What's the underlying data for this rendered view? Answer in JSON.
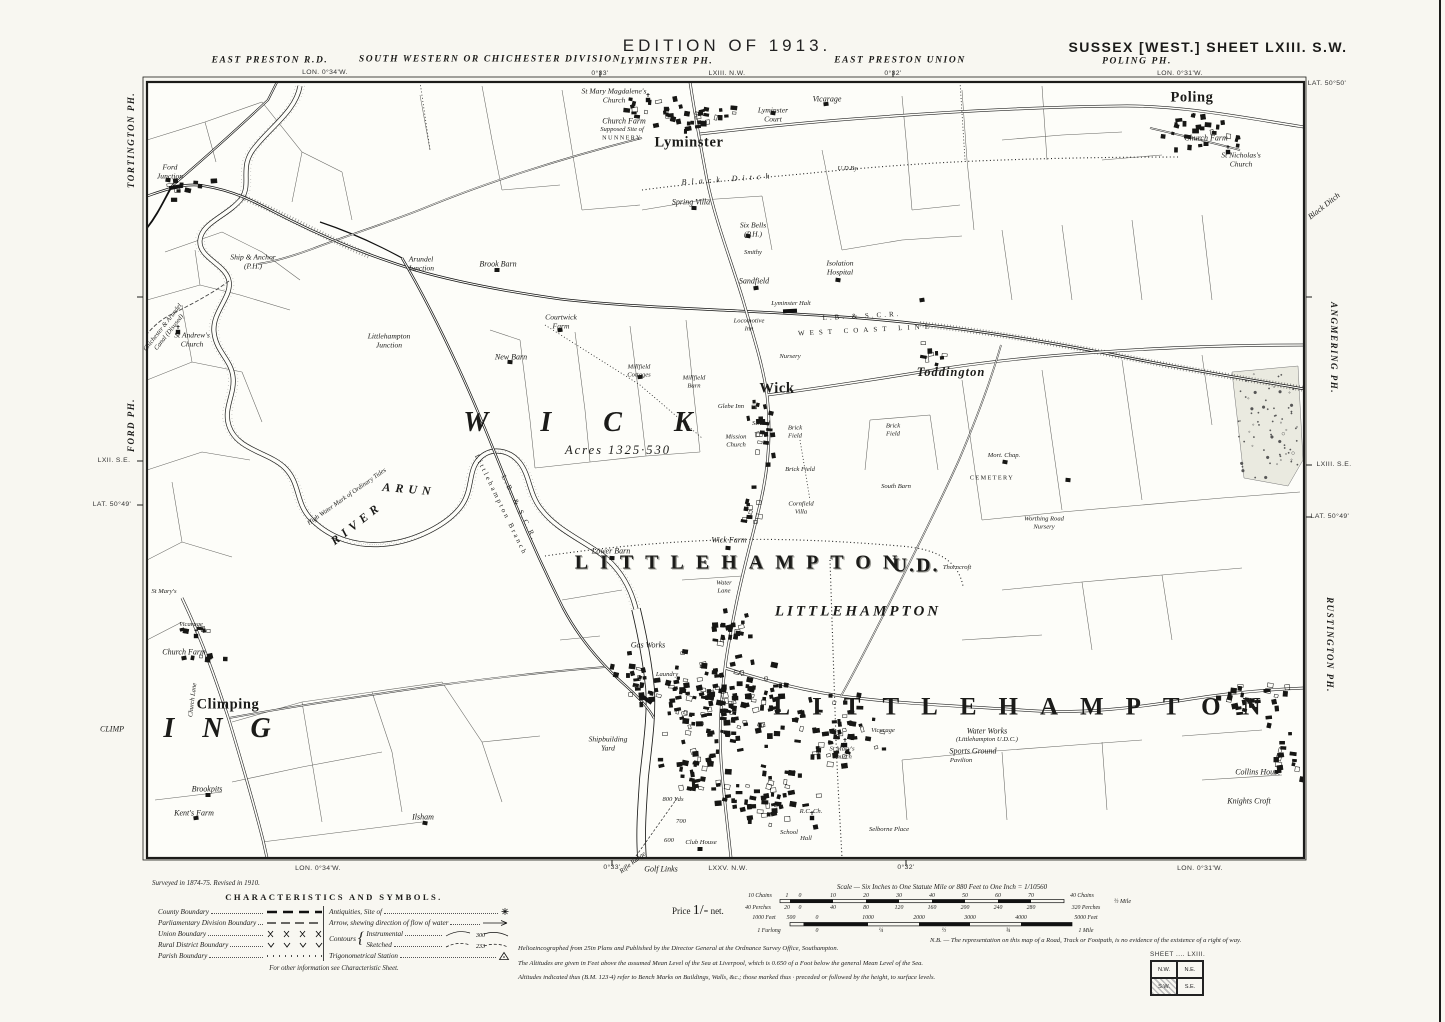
{
  "sheet_title": "SUSSEX [WEST.] SHEET LXIII. S.W.",
  "edition": "EDITION OF 1913.",
  "survey_note": "Surveyed in 1874-75.   Revised in 1910.",
  "price": {
    "prefix": "Price",
    "amount": "1/-",
    "suffix": "net."
  },
  "legend": {
    "title": "CHARACTERISTICS AND SYMBOLS.",
    "left": [
      {
        "label": "County Boundary",
        "sym": "county-dashes"
      },
      {
        "label": "Parliamentary Division Boundary",
        "sym": "thin-dashes"
      },
      {
        "label": "Union Boundary",
        "sym": "x-marks"
      },
      {
        "label": "Rural District Boundary",
        "sym": "v-marks"
      },
      {
        "label": "Parish Boundary",
        "sym": "dots"
      }
    ],
    "right": [
      {
        "label": "Antiquities, Site of",
        "sym": "antiquity-cross"
      },
      {
        "label": "Arrow, shewing direction of flow of water",
        "sym": "flow-arrow"
      }
    ],
    "contours": {
      "title": "Contours",
      "items": [
        {
          "label": "Instrumental",
          "value": "300"
        },
        {
          "label": "Sketched",
          "value": "233"
        }
      ]
    },
    "trig": {
      "label": "Trigonometrical Station",
      "sym": "trig-triangle"
    },
    "footnote": "For other information see Characteristic Sheet."
  },
  "scale": {
    "title": "Scale — Six Inches to One Statute Mile or 880 Feet to One Inch = 1/10560",
    "half_mile": "½ Mile",
    "tick_rows": [
      {
        "y": 893,
        "items": [
          {
            "t": "10 Chains",
            "x": 760
          },
          {
            "t": "1",
            "x": 787
          },
          {
            "t": "0",
            "x": 800
          },
          {
            "t": "10",
            "x": 833
          },
          {
            "t": "20",
            "x": 866
          },
          {
            "t": "30",
            "x": 899
          },
          {
            "t": "40",
            "x": 932
          },
          {
            "t": "50",
            "x": 965
          },
          {
            "t": "60",
            "x": 998
          },
          {
            "t": "70",
            "x": 1031
          },
          {
            "t": "40 Chains",
            "x": 1082
          }
        ]
      },
      {
        "y": 905,
        "items": [
          {
            "t": "40 Perches",
            "x": 758
          },
          {
            "t": "20",
            "x": 787
          },
          {
            "t": "0",
            "x": 800
          },
          {
            "t": "40",
            "x": 833
          },
          {
            "t": "80",
            "x": 866
          },
          {
            "t": "120",
            "x": 899
          },
          {
            "t": "160",
            "x": 932
          },
          {
            "t": "200",
            "x": 965
          },
          {
            "t": "240",
            "x": 998
          },
          {
            "t": "280",
            "x": 1031
          },
          {
            "t": "320 Perches",
            "x": 1086
          }
        ]
      },
      {
        "y": 915,
        "items": [
          {
            "t": "1000 Feet",
            "x": 764
          },
          {
            "t": "500",
            "x": 791
          },
          {
            "t": "0",
            "x": 817
          },
          {
            "t": "1000",
            "x": 868
          },
          {
            "t": "2000",
            "x": 919
          },
          {
            "t": "3000",
            "x": 970
          },
          {
            "t": "4000",
            "x": 1021
          },
          {
            "t": "5000 Feet",
            "x": 1086
          }
        ]
      },
      {
        "y": 928,
        "items": [
          {
            "t": "1 Furlong",
            "x": 769
          },
          {
            "t": "0",
            "x": 817
          },
          {
            "t": "¼",
            "x": 881
          },
          {
            "t": "½",
            "x": 944
          },
          {
            "t": "¾",
            "x": 1008
          },
          {
            "t": "1 Mile",
            "x": 1086
          }
        ]
      }
    ]
  },
  "notes": {
    "heliozincographed": "Heliozincographed from 25in Plans and Published by the Director General at the Ordnance Survey Office, Southampton.",
    "nb": "N.B. — The representation on this map of a Road, Track or Footpath, is no evidence of the existence of a right of way.",
    "altitudes1": "The Altitudes are given in Feet above the assumed Mean Level of the Sea at Liverpool, which is 0.650 of a Foot below the general Mean Level of the Sea.",
    "altitudes2": "Altitudes indicated thus (B.M. 123·4) refer to Bench Marks on Buildings, Walls, &c.; those marked thus · preceded or followed by the height, to surface levels."
  },
  "sheet_key": {
    "label": "SHEET .... LXIII.",
    "cells": [
      "N.W.",
      "N.E.",
      "S.W.",
      "S.E."
    ],
    "current": "S.W."
  },
  "map_labels": [
    {
      "t": "EDITION OF 1913.",
      "x": 727,
      "y": 46,
      "k": "hdr"
    },
    {
      "t": "SUSSEX [WEST.] SHEET LXIII. S.W.",
      "x": 1208,
      "y": 47,
      "k": "hdr2"
    },
    {
      "t": "EAST PRESTON R.D.",
      "x": 270,
      "y": 61,
      "k": "ph"
    },
    {
      "t": "LON. 0°34'W.",
      "x": 325,
      "y": 73,
      "k": "coord"
    },
    {
      "t": "SOUTH WESTERN OR CHICHESTER DIVISION",
      "x": 490,
      "y": 60,
      "k": "ph"
    },
    {
      "t": "LYMINSTER PH.",
      "x": 667,
      "y": 62,
      "k": "ph"
    },
    {
      "t": "LXIII. N.W.",
      "x": 727,
      "y": 74,
      "k": "coord"
    },
    {
      "t": "0°33'",
      "x": 600,
      "y": 74,
      "k": "coord"
    },
    {
      "t": "EAST PRESTON UNION",
      "x": 900,
      "y": 61,
      "k": "ph"
    },
    {
      "t": "0°32'",
      "x": 893,
      "y": 74,
      "k": "coord"
    },
    {
      "t": "POLING PH.",
      "x": 1137,
      "y": 62,
      "k": "ph"
    },
    {
      "t": "LON. 0°31'W.",
      "x": 1180,
      "y": 74,
      "k": "coord"
    },
    {
      "t": "LAT. 50°50'",
      "x": 1327,
      "y": 84,
      "k": "coord"
    },
    {
      "t": "TORTINGTON PH.",
      "x": 131,
      "y": 140,
      "k": "phv",
      "rot": -90
    },
    {
      "t": "FORD PH.",
      "x": 131,
      "y": 425,
      "k": "phv",
      "rot": -90
    },
    {
      "t": "LXII. S.E.",
      "x": 114,
      "y": 461,
      "k": "coord"
    },
    {
      "t": "LAT. 50°49'",
      "x": 112,
      "y": 505,
      "k": "coord"
    },
    {
      "t": "CLIMP",
      "x": 112,
      "y": 729,
      "k": "feat"
    },
    {
      "t": "Black Ditch",
      "x": 1324,
      "y": 206,
      "k": "feat",
      "rot": -38
    },
    {
      "t": "ANGMERING PH.",
      "x": 1334,
      "y": 348,
      "k": "phv",
      "rot": 90
    },
    {
      "t": "LXIII. S.E.",
      "x": 1334,
      "y": 465,
      "k": "coord"
    },
    {
      "t": "LAT. 50°49'",
      "x": 1330,
      "y": 517,
      "k": "coord"
    },
    {
      "t": "RUSTINGTON PH.",
      "x": 1330,
      "y": 645,
      "k": "phv",
      "rot": 90
    },
    {
      "t": "LON. 0°34'W.",
      "x": 318,
      "y": 869,
      "k": "coord"
    },
    {
      "t": "0°33'",
      "x": 612,
      "y": 868,
      "k": "coord"
    },
    {
      "t": "Rifle Range",
      "x": 633,
      "y": 863,
      "k": "tiny",
      "rot": -38
    },
    {
      "t": "Golf Links",
      "x": 661,
      "y": 869,
      "k": "feat"
    },
    {
      "t": "LXXV. N.W.",
      "x": 728,
      "y": 869,
      "k": "coord"
    },
    {
      "t": "0°32'",
      "x": 906,
      "y": 868,
      "k": "coord"
    },
    {
      "t": "LON. 0°31'W.",
      "x": 1200,
      "y": 869,
      "k": "coord"
    },
    {
      "t": "Ford\nJunction",
      "x": 170,
      "y": 172,
      "k": "feat2"
    },
    {
      "t": "Ship & Anchor\n(P.H.)",
      "x": 253,
      "y": 262,
      "k": "feat2"
    },
    {
      "t": "Arundel\nJunction",
      "x": 421,
      "y": 264,
      "k": "feat2"
    },
    {
      "t": "Brook Barn",
      "x": 498,
      "y": 264,
      "k": "feat"
    },
    {
      "t": "Littlehampton\nJunction",
      "x": 389,
      "y": 341,
      "k": "feat2"
    },
    {
      "t": "St Andrew's\nChurch",
      "x": 192,
      "y": 340,
      "k": "feat2"
    },
    {
      "t": "Chichester & Arundel\nCanal (Disused)",
      "x": 166,
      "y": 330,
      "k": "tiny",
      "rot": -52
    },
    {
      "t": "St Mary Magdalene's\nChurch",
      "x": 614,
      "y": 96,
      "k": "feat2"
    },
    {
      "t": "Church Farm",
      "x": 624,
      "y": 121,
      "k": "feat"
    },
    {
      "t": "Supposed Site of",
      "x": 622,
      "y": 130,
      "k": "tiny"
    },
    {
      "t": "NUNNERY",
      "x": 622,
      "y": 138,
      "k": "caps"
    },
    {
      "t": "Lyminster",
      "x": 689,
      "y": 143,
      "k": "town"
    },
    {
      "t": "Lyminster\nCourt",
      "x": 773,
      "y": 115,
      "k": "feat2"
    },
    {
      "t": "Vicarage",
      "x": 827,
      "y": 99,
      "k": "feat"
    },
    {
      "t": "Black Ditch",
      "x": 728,
      "y": 179,
      "k": "feat",
      "ls": 5,
      "rot": -4
    },
    {
      "t": "Spring Villa",
      "x": 691,
      "y": 202,
      "k": "feat"
    },
    {
      "t": "Six Bells\n(P.H.)",
      "x": 753,
      "y": 230,
      "k": "feat2"
    },
    {
      "t": "Smithy",
      "x": 753,
      "y": 253,
      "k": "tiny"
    },
    {
      "t": "Sandfield",
      "x": 754,
      "y": 281,
      "k": "feat"
    },
    {
      "t": "Isolation\nHospital",
      "x": 840,
      "y": 268,
      "k": "feat2"
    },
    {
      "t": "U.D.By.",
      "x": 848,
      "y": 169,
      "k": "tiny"
    },
    {
      "t": "Poling",
      "x": 1192,
      "y": 98,
      "k": "town"
    },
    {
      "t": "Church Farm",
      "x": 1206,
      "y": 138,
      "k": "feat"
    },
    {
      "t": "St Nicholas's\nChurch",
      "x": 1241,
      "y": 160,
      "k": "feat2"
    },
    {
      "t": "L.B. & S.C.R.",
      "x": 862,
      "y": 316,
      "k": "rail",
      "rot": -3,
      "ls": 3
    },
    {
      "t": "WEST COAST LINE",
      "x": 866,
      "y": 330,
      "k": "rail",
      "rot": -3,
      "ls": 5
    },
    {
      "t": "Lyminster Halt",
      "x": 791,
      "y": 304,
      "k": "tiny"
    },
    {
      "t": "Locomotive\nInn",
      "x": 749,
      "y": 325,
      "k": "tiny"
    },
    {
      "t": "L.B. & S.C.R.",
      "x": 519,
      "y": 508,
      "k": "rail",
      "rot": 64
    },
    {
      "t": "Littlehampton Branch",
      "x": 501,
      "y": 505,
      "k": "rail",
      "rot": 64
    },
    {
      "t": "Toddington",
      "x": 951,
      "y": 372,
      "k": "towni"
    },
    {
      "t": "Wick",
      "x": 777,
      "y": 389,
      "k": "town"
    },
    {
      "t": "Nursery",
      "x": 790,
      "y": 357,
      "k": "tiny"
    },
    {
      "t": "WICK",
      "x": 604,
      "y": 423,
      "k": "giant",
      "ls": 52
    },
    {
      "t": "Acres 1325·530",
      "x": 618,
      "y": 450,
      "k": "acres"
    },
    {
      "t": "Glebe Inn",
      "x": 731,
      "y": 407,
      "k": "tiny"
    },
    {
      "t": "School",
      "x": 761,
      "y": 424,
      "k": "tiny"
    },
    {
      "t": "Brick\nField",
      "x": 795,
      "y": 432,
      "k": "tiny"
    },
    {
      "t": "Mission\nChurch",
      "x": 736,
      "y": 441,
      "k": "tiny"
    },
    {
      "t": "Brick Field",
      "x": 800,
      "y": 470,
      "k": "tiny"
    },
    {
      "t": "Brick\nField",
      "x": 893,
      "y": 430,
      "k": "tiny"
    },
    {
      "t": "South Barn",
      "x": 896,
      "y": 487,
      "k": "tiny"
    },
    {
      "t": "Cornfield\nVilla",
      "x": 801,
      "y": 508,
      "k": "tiny"
    },
    {
      "t": "Mort. Chap.",
      "x": 1004,
      "y": 456,
      "k": "tiny"
    },
    {
      "t": "CEMETERY",
      "x": 992,
      "y": 478,
      "k": "caps"
    },
    {
      "t": "Worthing Road\nNursery",
      "x": 1044,
      "y": 523,
      "k": "tiny"
    },
    {
      "t": "Millfield\nCottages",
      "x": 639,
      "y": 371,
      "k": "tiny"
    },
    {
      "t": "Millfield\nBarn",
      "x": 694,
      "y": 382,
      "k": "tiny"
    },
    {
      "t": "New Barn",
      "x": 511,
      "y": 357,
      "k": "feat"
    },
    {
      "t": "Courtwick\nFarm",
      "x": 561,
      "y": 322,
      "k": "feat2"
    },
    {
      "t": "Wick Farm",
      "x": 729,
      "y": 540,
      "k": "feat"
    },
    {
      "t": "Lower Barn",
      "x": 611,
      "y": 551,
      "k": "feat"
    },
    {
      "t": "Thorncroft",
      "x": 957,
      "y": 568,
      "k": "tiny"
    },
    {
      "t": "Water\nLane",
      "x": 724,
      "y": 587,
      "k": "tiny"
    },
    {
      "t": "RIVER",
      "x": 357,
      "y": 524,
      "k": "river",
      "rot": -38,
      "ls": 5
    },
    {
      "t": "ARUN",
      "x": 409,
      "y": 490,
      "k": "river",
      "rot": 5,
      "ls": 5
    },
    {
      "t": "High Water Mark of Ordinary Tides",
      "x": 347,
      "y": 497,
      "k": "tiny",
      "rot": -35
    },
    {
      "t": "LITTLEHAMPTON",
      "x": 742,
      "y": 563,
      "k": "block",
      "ls": 12
    },
    {
      "t": "U.D.",
      "x": 916,
      "y": 566,
      "k": "block",
      "ls": 2
    },
    {
      "t": "LITTLEHAMPTON",
      "x": 858,
      "y": 612,
      "k": "townlg",
      "ls": 3
    },
    {
      "t": "LITTLEHAMPTON",
      "x": 1028,
      "y": 708,
      "k": "giant2",
      "ls": 22
    },
    {
      "t": "Gas Works",
      "x": 648,
      "y": 645,
      "k": "feat"
    },
    {
      "t": "Laundry",
      "x": 667,
      "y": 675,
      "k": "tiny"
    },
    {
      "t": "Shipbuilding\nYard",
      "x": 608,
      "y": 744,
      "k": "feat2"
    },
    {
      "t": "Vicarage",
      "x": 883,
      "y": 731,
      "k": "tiny"
    },
    {
      "t": "St Mary's\nChurch",
      "x": 842,
      "y": 753,
      "k": "tiny"
    },
    {
      "t": "Water Works",
      "x": 987,
      "y": 731,
      "k": "feat"
    },
    {
      "t": "(Littlehampton U.D.C.)",
      "x": 987,
      "y": 740,
      "k": "tiny"
    },
    {
      "t": "Sports Ground",
      "x": 973,
      "y": 751,
      "k": "feat"
    },
    {
      "t": "Pavilion",
      "x": 961,
      "y": 761,
      "k": "tiny"
    },
    {
      "t": "Collins House",
      "x": 1258,
      "y": 772,
      "k": "feat"
    },
    {
      "t": "Knights Croft",
      "x": 1249,
      "y": 801,
      "k": "feat"
    },
    {
      "t": "Climping",
      "x": 228,
      "y": 705,
      "k": "town"
    },
    {
      "t": "ING",
      "x": 231,
      "y": 729,
      "k": "giant",
      "ls": 28
    },
    {
      "t": "Church Farm",
      "x": 184,
      "y": 652,
      "k": "feat"
    },
    {
      "t": "Vicarage",
      "x": 191,
      "y": 625,
      "k": "tiny"
    },
    {
      "t": "St Mary's",
      "x": 164,
      "y": 592,
      "k": "tiny"
    },
    {
      "t": "Church Lane",
      "x": 193,
      "y": 700,
      "k": "tiny",
      "rot": -83
    },
    {
      "t": "Brookpits",
      "x": 207,
      "y": 789,
      "k": "feat"
    },
    {
      "t": "Kent's Farm",
      "x": 194,
      "y": 813,
      "k": "feat"
    },
    {
      "t": "Ilsham",
      "x": 423,
      "y": 817,
      "k": "feat"
    },
    {
      "t": "800 Yds",
      "x": 673,
      "y": 800,
      "k": "tiny"
    },
    {
      "t": "700",
      "x": 681,
      "y": 822,
      "k": "tiny"
    },
    {
      "t": "600",
      "x": 669,
      "y": 841,
      "k": "tiny"
    },
    {
      "t": "Club House",
      "x": 701,
      "y": 843,
      "k": "tiny"
    },
    {
      "t": "R.C. Ch.",
      "x": 811,
      "y": 812,
      "k": "tiny"
    },
    {
      "t": "School",
      "x": 789,
      "y": 833,
      "k": "tiny"
    },
    {
      "t": "Hall",
      "x": 806,
      "y": 839,
      "k": "tiny"
    },
    {
      "t": "Selborne Place",
      "x": 889,
      "y": 830,
      "k": "tiny"
    }
  ]
}
